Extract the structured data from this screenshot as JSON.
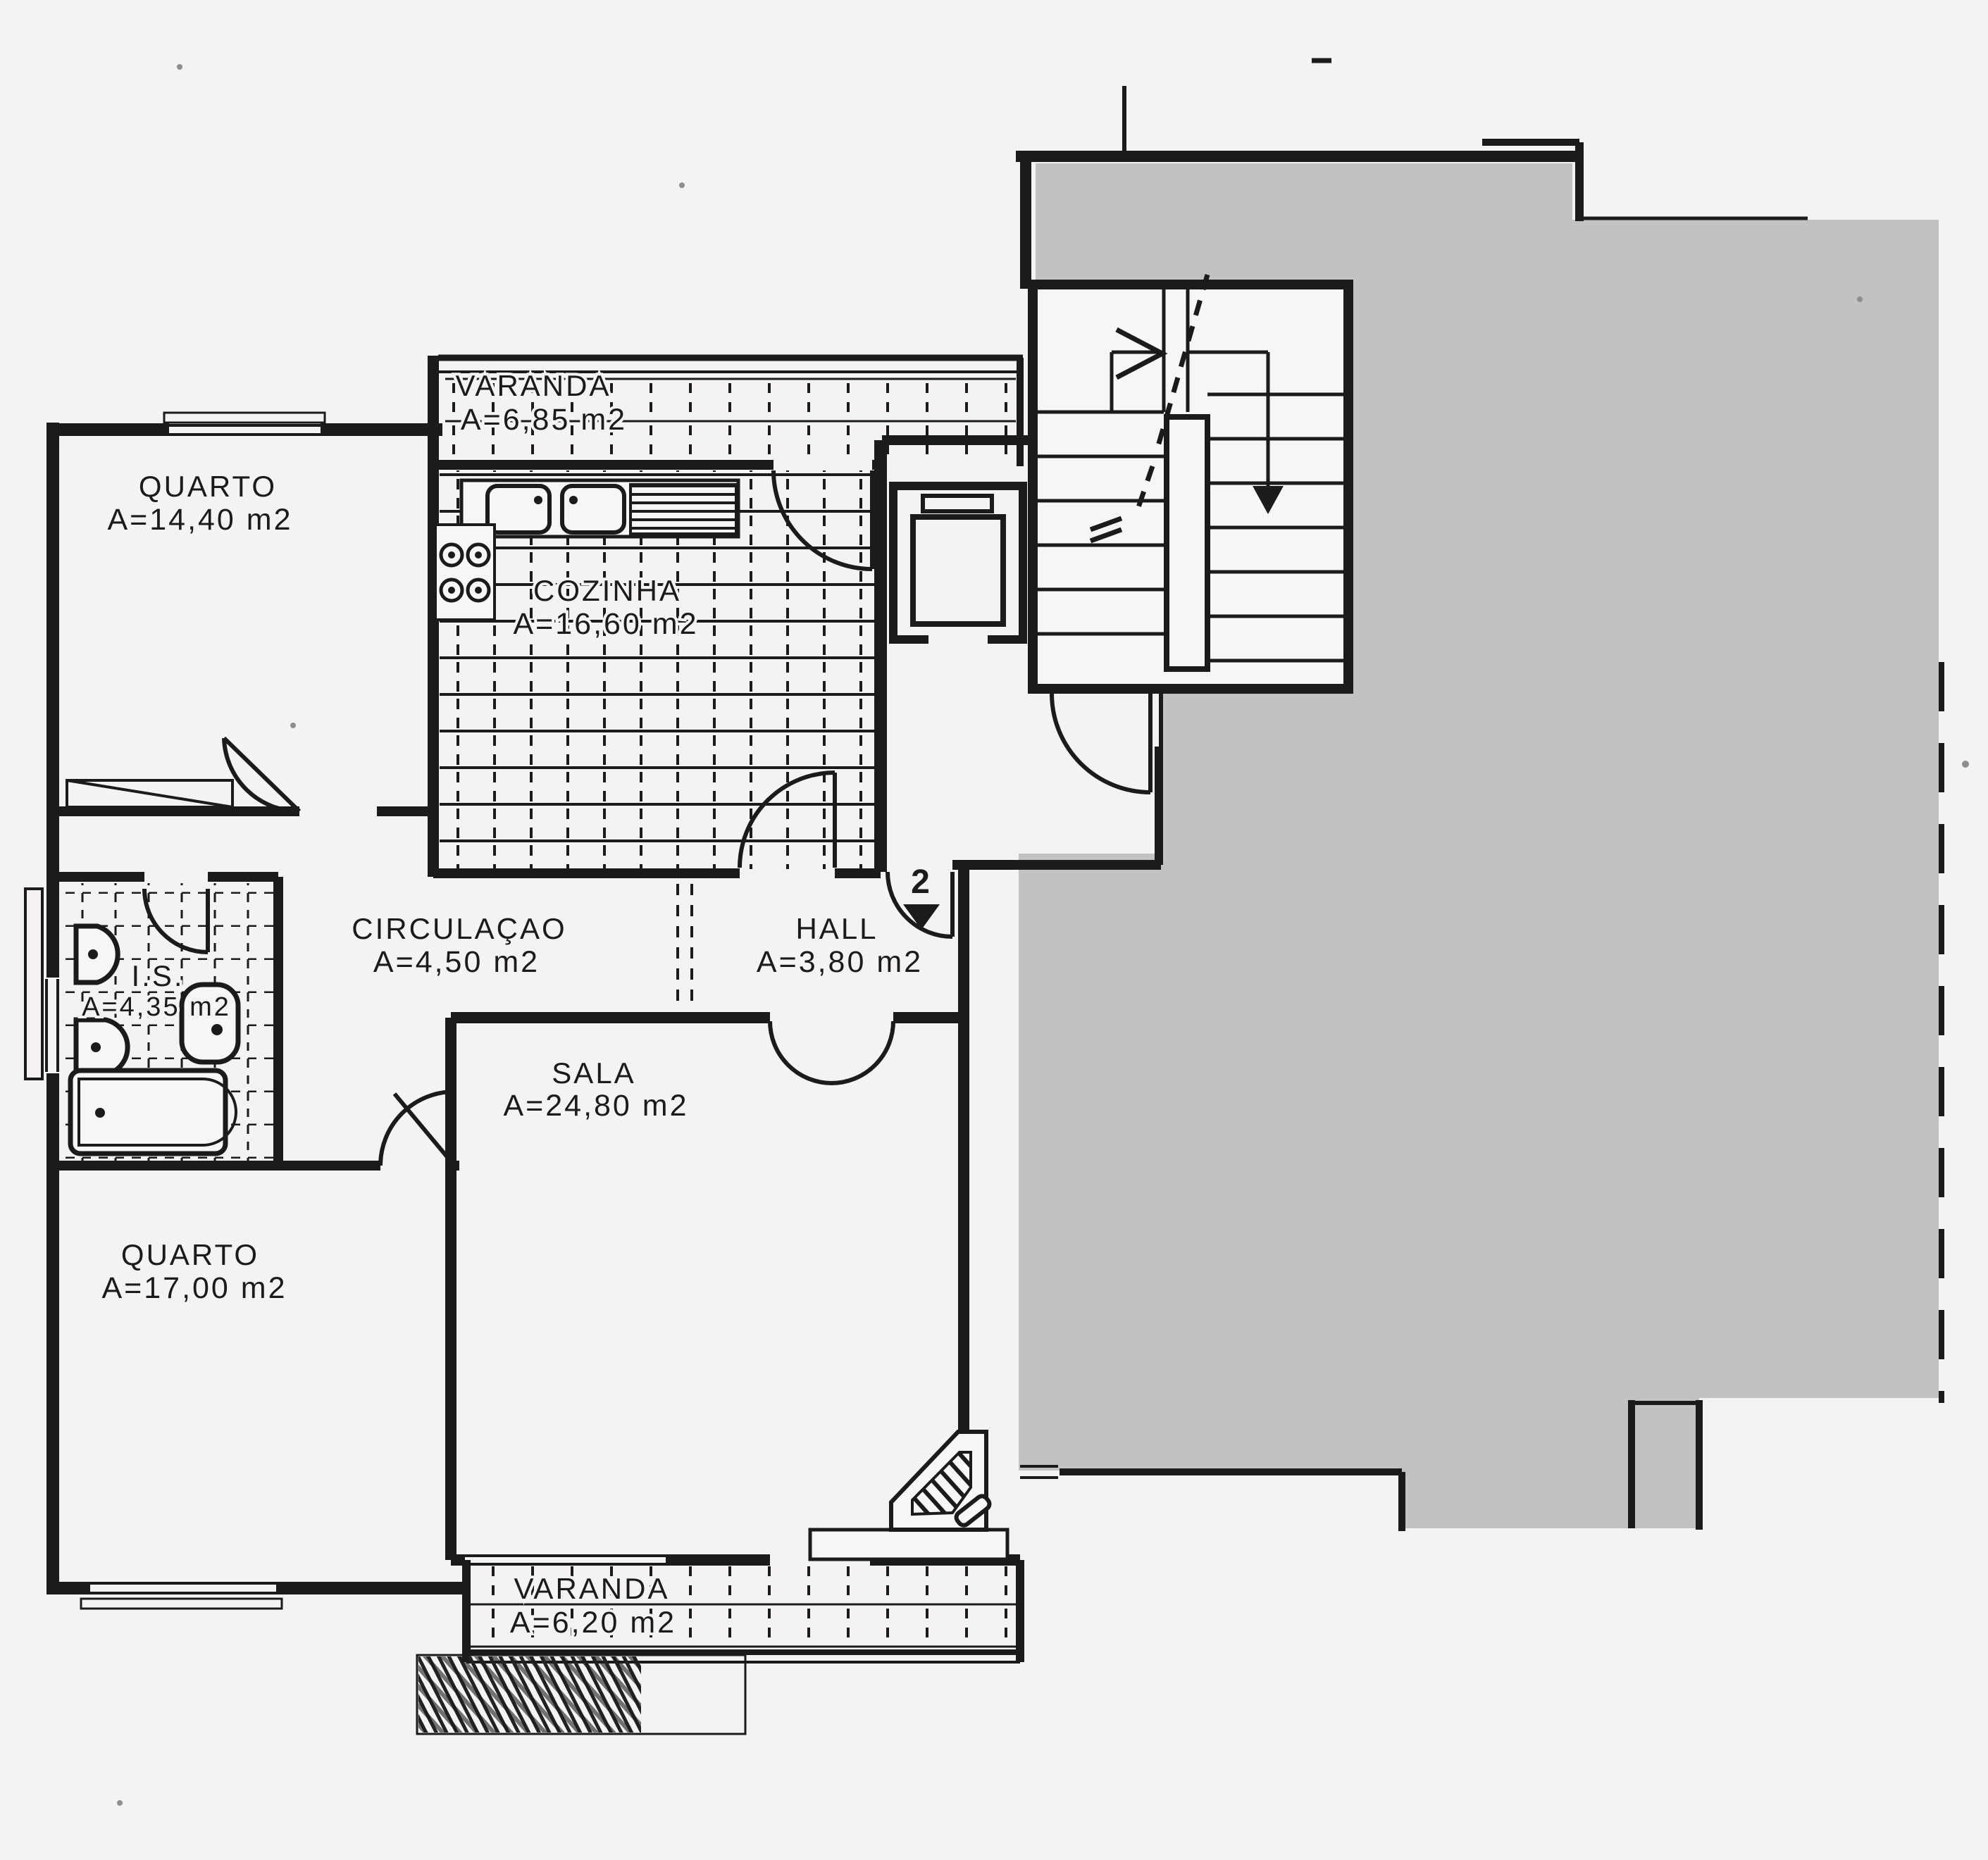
{
  "plan": {
    "rooms": {
      "varanda_top": {
        "name": "VARANDA",
        "area": "A=6,85  m2"
      },
      "quarto_top": {
        "name": "QUARTO",
        "area": "A=14,40  m2"
      },
      "cozinha": {
        "name": "COZINHA",
        "area": "A=16,60  m2"
      },
      "circulacao": {
        "name": "CIRCULAÇAO",
        "area": "A=4,50  m2"
      },
      "hall": {
        "name": "HALL",
        "area": "A=3,80  m2"
      },
      "is": {
        "name": "I.S.",
        "area": "A=4,35 m2"
      },
      "sala": {
        "name": "SALA",
        "area": "A=24,80  m2"
      },
      "quarto_bottom": {
        "name": "QUARTO",
        "area": "A=17,00  m2"
      },
      "varanda_bottom": {
        "name": "VARANDA",
        "area": "A=6,20  m2"
      }
    },
    "entrance": {
      "unit_number": "2"
    },
    "colors": {
      "paper": "#f5f2f3",
      "ink": "#1b1b1b",
      "mask_gray": "#c3c2c2"
    }
  }
}
